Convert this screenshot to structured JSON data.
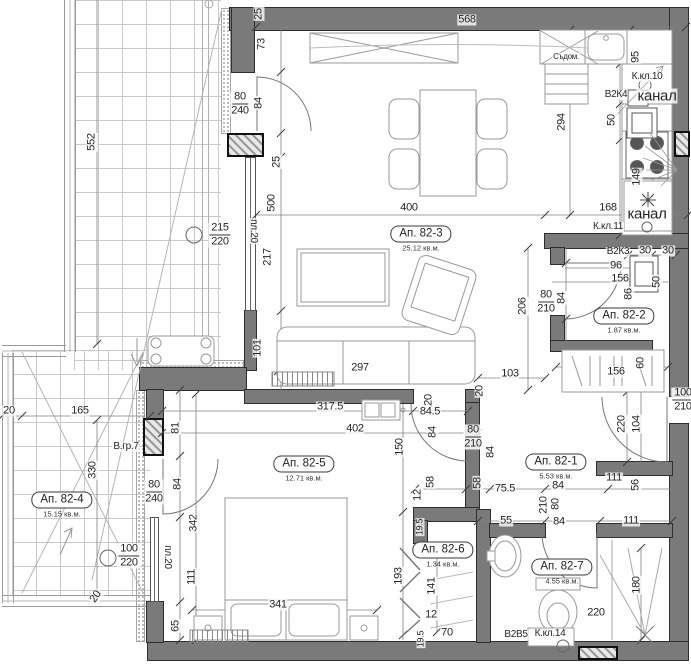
{
  "plan": {
    "rooms": [
      {
        "id": "82-3",
        "name": "Ап. 82-3",
        "area": "25.12 кв.м.",
        "x": 421,
        "y": 239
      },
      {
        "id": "82-2",
        "name": "Ап. 82-2",
        "area": "1.87 кв.м.",
        "x": 624,
        "y": 321
      },
      {
        "id": "82-1",
        "name": "Ап. 82-1",
        "area": "5.53 кв.м.",
        "x": 556,
        "y": 467
      },
      {
        "id": "82-5",
        "name": "Ап. 82-5",
        "area": "12.71 кв.м.",
        "x": 304,
        "y": 469
      },
      {
        "id": "82-4",
        "name": "Ап. 82-4",
        "area": "15.15 кв.м.",
        "x": 62,
        "y": 505
      },
      {
        "id": "82-6",
        "name": "Ап. 82-6",
        "area": "1.34 кв.м.",
        "x": 443,
        "y": 555
      },
      {
        "id": "82-7",
        "name": "Ап. 82-7",
        "area": "4.55 кв.м.",
        "x": 562,
        "y": 572
      }
    ],
    "labels": [
      {
        "t": "568",
        "x": 467,
        "y": 20
      },
      {
        "t": "80",
        "t2": "240",
        "x": 240,
        "y": 104
      },
      {
        "t": "215",
        "t2": "220",
        "x": 220,
        "y": 235
      },
      {
        "t": "400",
        "x": 409,
        "y": 208
      },
      {
        "t": "168",
        "x": 608,
        "y": 208
      },
      {
        "t": "К.кл.10",
        "x": 647,
        "y": 77,
        "s": 10
      },
      {
        "t": "В2К4",
        "x": 616,
        "y": 95,
        "s": 10
      },
      {
        "t": "канал",
        "x": 657,
        "y": 96,
        "s": 15
      },
      {
        "t": "канал",
        "x": 647,
        "y": 214,
        "s": 15
      },
      {
        "t": "К.кл.11",
        "x": 608,
        "y": 227,
        "s": 10
      },
      {
        "t": "В2К3",
        "x": 618,
        "y": 252,
        "s": 10
      },
      {
        "t": "30",
        "x": 645,
        "y": 251
      },
      {
        "t": "30",
        "x": 668,
        "y": 251
      },
      {
        "t": "96",
        "x": 616,
        "y": 266
      },
      {
        "t": "156",
        "x": 620,
        "y": 279
      },
      {
        "t": "80",
        "t2": "210",
        "x": 546,
        "y": 302
      },
      {
        "t": "103",
        "x": 510,
        "y": 374
      },
      {
        "t": "297",
        "x": 360,
        "y": 368
      },
      {
        "t": "156",
        "x": 616,
        "y": 372
      },
      {
        "t": "317.5",
        "x": 330,
        "y": 407
      },
      {
        "t": "402",
        "x": 355,
        "y": 429
      },
      {
        "t": "84.5",
        "x": 430,
        "y": 412
      },
      {
        "t": "80",
        "t2": "210",
        "x": 473,
        "y": 437
      },
      {
        "t": "165",
        "x": 80,
        "y": 411
      },
      {
        "t": "20",
        "x": 9,
        "y": 411
      },
      {
        "t": "В.гр.7",
        "x": 126,
        "y": 447,
        "s": 10
      },
      {
        "t": "80",
        "t2": "240",
        "x": 154,
        "y": 492
      },
      {
        "t": "100",
        "t2": "220",
        "x": 129,
        "y": 556
      },
      {
        "t": "341",
        "x": 278,
        "y": 605
      },
      {
        "t": "75.5",
        "x": 505,
        "y": 489
      },
      {
        "t": "55",
        "x": 506,
        "y": 521
      },
      {
        "t": "100",
        "t2": "210",
        "x": 683,
        "y": 400
      },
      {
        "t": "111",
        "x": 614,
        "y": 478
      },
      {
        "t": "111",
        "x": 631,
        "y": 521
      },
      {
        "t": "84",
        "x": 558,
        "y": 486
      },
      {
        "t": "84",
        "x": 559,
        "y": 522
      },
      {
        "t": "Съдом.",
        "x": 566,
        "y": 57,
        "s": 8
      },
      {
        "t": "В2В5",
        "x": 516,
        "y": 635,
        "s": 10
      },
      {
        "t": "К.кл.14",
        "x": 550,
        "y": 634,
        "s": 10
      },
      {
        "t": "220",
        "x": 596,
        "y": 613
      },
      {
        "t": "12",
        "x": 431,
        "y": 615
      },
      {
        "t": "70",
        "x": 447,
        "y": 633
      },
      {
        "t": "20",
        "x": 96,
        "y": 597,
        "r": -55
      },
      {
        "t": "552",
        "x": 92,
        "y": 142,
        "r": -90
      },
      {
        "t": "25",
        "x": 259,
        "y": 14,
        "r": -90
      },
      {
        "t": "73",
        "x": 262,
        "y": 44,
        "r": -90
      },
      {
        "t": "84",
        "x": 259,
        "y": 103,
        "r": -90
      },
      {
        "t": "25",
        "x": 277,
        "y": 162,
        "r": -90
      },
      {
        "t": "500",
        "x": 272,
        "y": 203,
        "r": -90
      },
      {
        "t": "217",
        "x": 268,
        "y": 257,
        "r": -90
      },
      {
        "t": "101",
        "x": 258,
        "y": 348,
        "r": -90
      },
      {
        "t": "294",
        "x": 562,
        "y": 122,
        "r": -90
      },
      {
        "t": "95",
        "x": 636,
        "y": 57,
        "r": -90
      },
      {
        "t": "50",
        "x": 612,
        "y": 120,
        "r": -90
      },
      {
        "t": "149",
        "x": 637,
        "y": 177,
        "r": -90
      },
      {
        "t": "50",
        "x": 657,
        "y": 282,
        "r": -90
      },
      {
        "t": "86",
        "x": 629,
        "y": 294,
        "r": -90
      },
      {
        "t": "84",
        "x": 562,
        "y": 298,
        "r": -90
      },
      {
        "t": "206",
        "x": 523,
        "y": 306,
        "r": -90
      },
      {
        "t": "60",
        "x": 641,
        "y": 363,
        "r": -90
      },
      {
        "t": "220",
        "x": 622,
        "y": 424,
        "r": -90
      },
      {
        "t": "104",
        "x": 637,
        "y": 424,
        "r": -90
      },
      {
        "t": "81",
        "x": 176,
        "y": 428,
        "r": -90
      },
      {
        "t": "84",
        "x": 178,
        "y": 484,
        "r": -90
      },
      {
        "t": "342",
        "x": 194,
        "y": 523,
        "r": -90
      },
      {
        "t": "пл.20",
        "x": 167,
        "y": 557,
        "r": 90,
        "s": 10
      },
      {
        "t": "111",
        "x": 192,
        "y": 577,
        "r": -90
      },
      {
        "t": "65",
        "x": 176,
        "y": 626,
        "r": -90
      },
      {
        "t": "20",
        "x": 429,
        "y": 400,
        "r": -90
      },
      {
        "t": "84",
        "x": 433,
        "y": 432,
        "r": -90
      },
      {
        "t": "84",
        "x": 491,
        "y": 452,
        "r": -90
      },
      {
        "t": "150",
        "x": 400,
        "y": 447,
        "r": -90
      },
      {
        "t": "58",
        "x": 431,
        "y": 482,
        "r": -90
      },
      {
        "t": "58",
        "x": 478,
        "y": 483,
        "r": -90
      },
      {
        "t": "12",
        "x": 418,
        "y": 495,
        "r": -90
      },
      {
        "t": "56",
        "x": 636,
        "y": 485,
        "r": -90
      },
      {
        "t": "210",
        "x": 544,
        "y": 505,
        "r": -90
      },
      {
        "t": "80",
        "x": 556,
        "y": 504,
        "r": -90
      },
      {
        "t": "193",
        "x": 399,
        "y": 576,
        "r": -90
      },
      {
        "t": "141",
        "x": 432,
        "y": 586,
        "r": -90
      },
      {
        "t": "19.5",
        "x": 420,
        "y": 527,
        "r": -90,
        "s": 9
      },
      {
        "t": "19.5",
        "x": 421,
        "y": 639,
        "r": -90,
        "s": 9
      },
      {
        "t": "180",
        "x": 637,
        "y": 585,
        "r": -90
      },
      {
        "t": "330",
        "x": 93,
        "y": 470,
        "r": -90
      },
      {
        "t": "пл.20",
        "x": 253,
        "y": 231,
        "r": 90,
        "s": 10
      },
      {
        "t": "20",
        "x": 480,
        "y": 391,
        "r": -90
      }
    ]
  }
}
